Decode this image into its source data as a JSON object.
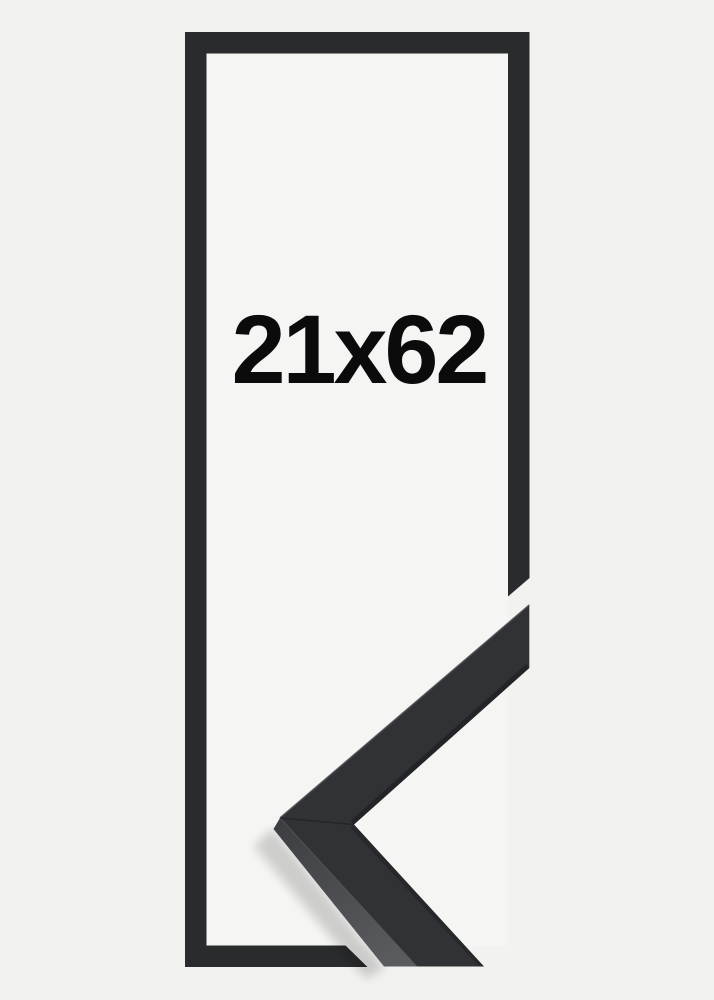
{
  "product_illustration": {
    "size_label": "21x62",
    "subject": "black picture frame size outline with mitered corner sample"
  },
  "colors": {
    "background": "#f2f2f1",
    "inner_background": "#f5f5f4",
    "frame_outline": "#2a2b2d",
    "sample_face": "#313235",
    "sample_side_dark": "#3d3e41",
    "sample_side_light": "#5a5b5f",
    "label_text": "#0b0b0b"
  }
}
